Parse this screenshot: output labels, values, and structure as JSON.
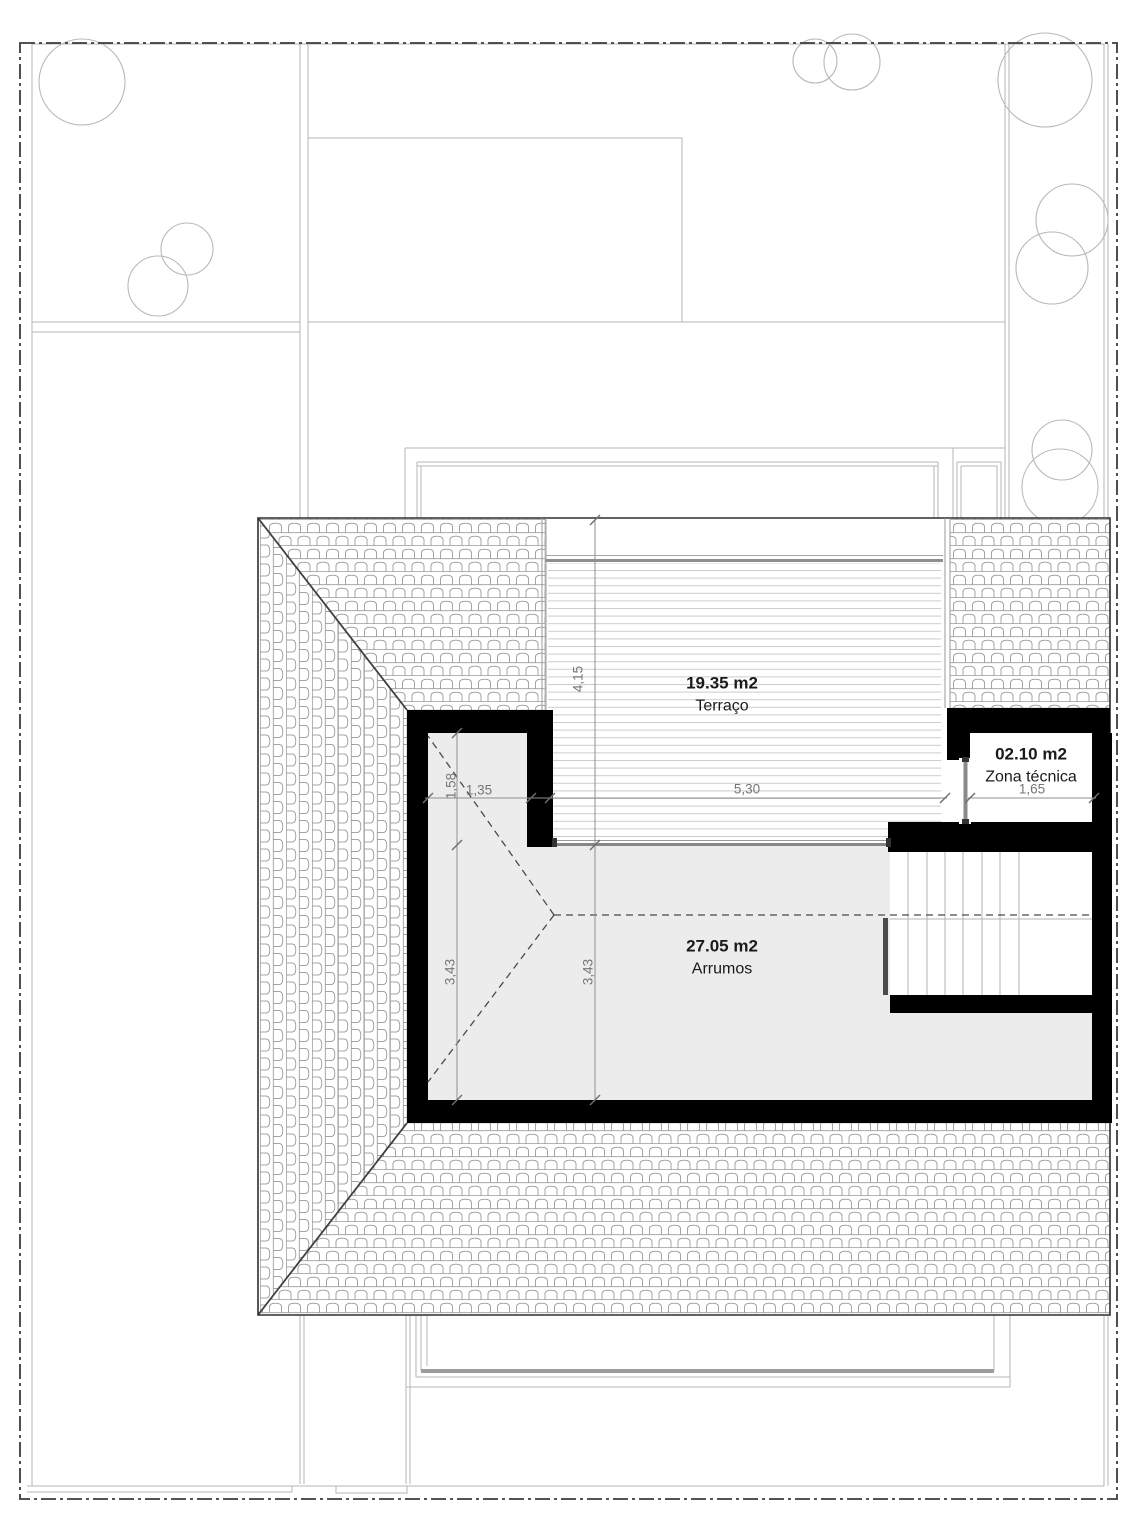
{
  "plan": {
    "drawing_type": "roof / attic floor plan",
    "rooms": [
      {
        "area": "19.35 m2",
        "name": "Terraço"
      },
      {
        "area": "02.10 m2",
        "name": "Zona técnica"
      },
      {
        "area": "27.05 m2",
        "name": "Arrumos"
      }
    ],
    "dimensions": {
      "terrace_depth": "4,15",
      "terrace_width": "5,30",
      "notch_width": "1,35",
      "notch_height": "1,58",
      "storage_height_left": "3,43",
      "storage_height_mid": "3,43",
      "technical_zone_width": "1,65"
    },
    "colors": {
      "wall": "#000000",
      "room_fill": "#ececec",
      "dimension_text": "#767676",
      "site_line": "#b5b5b5",
      "boundary_line": "#3c3c3c",
      "roof_hatch_line": "#9b9b9b"
    }
  }
}
